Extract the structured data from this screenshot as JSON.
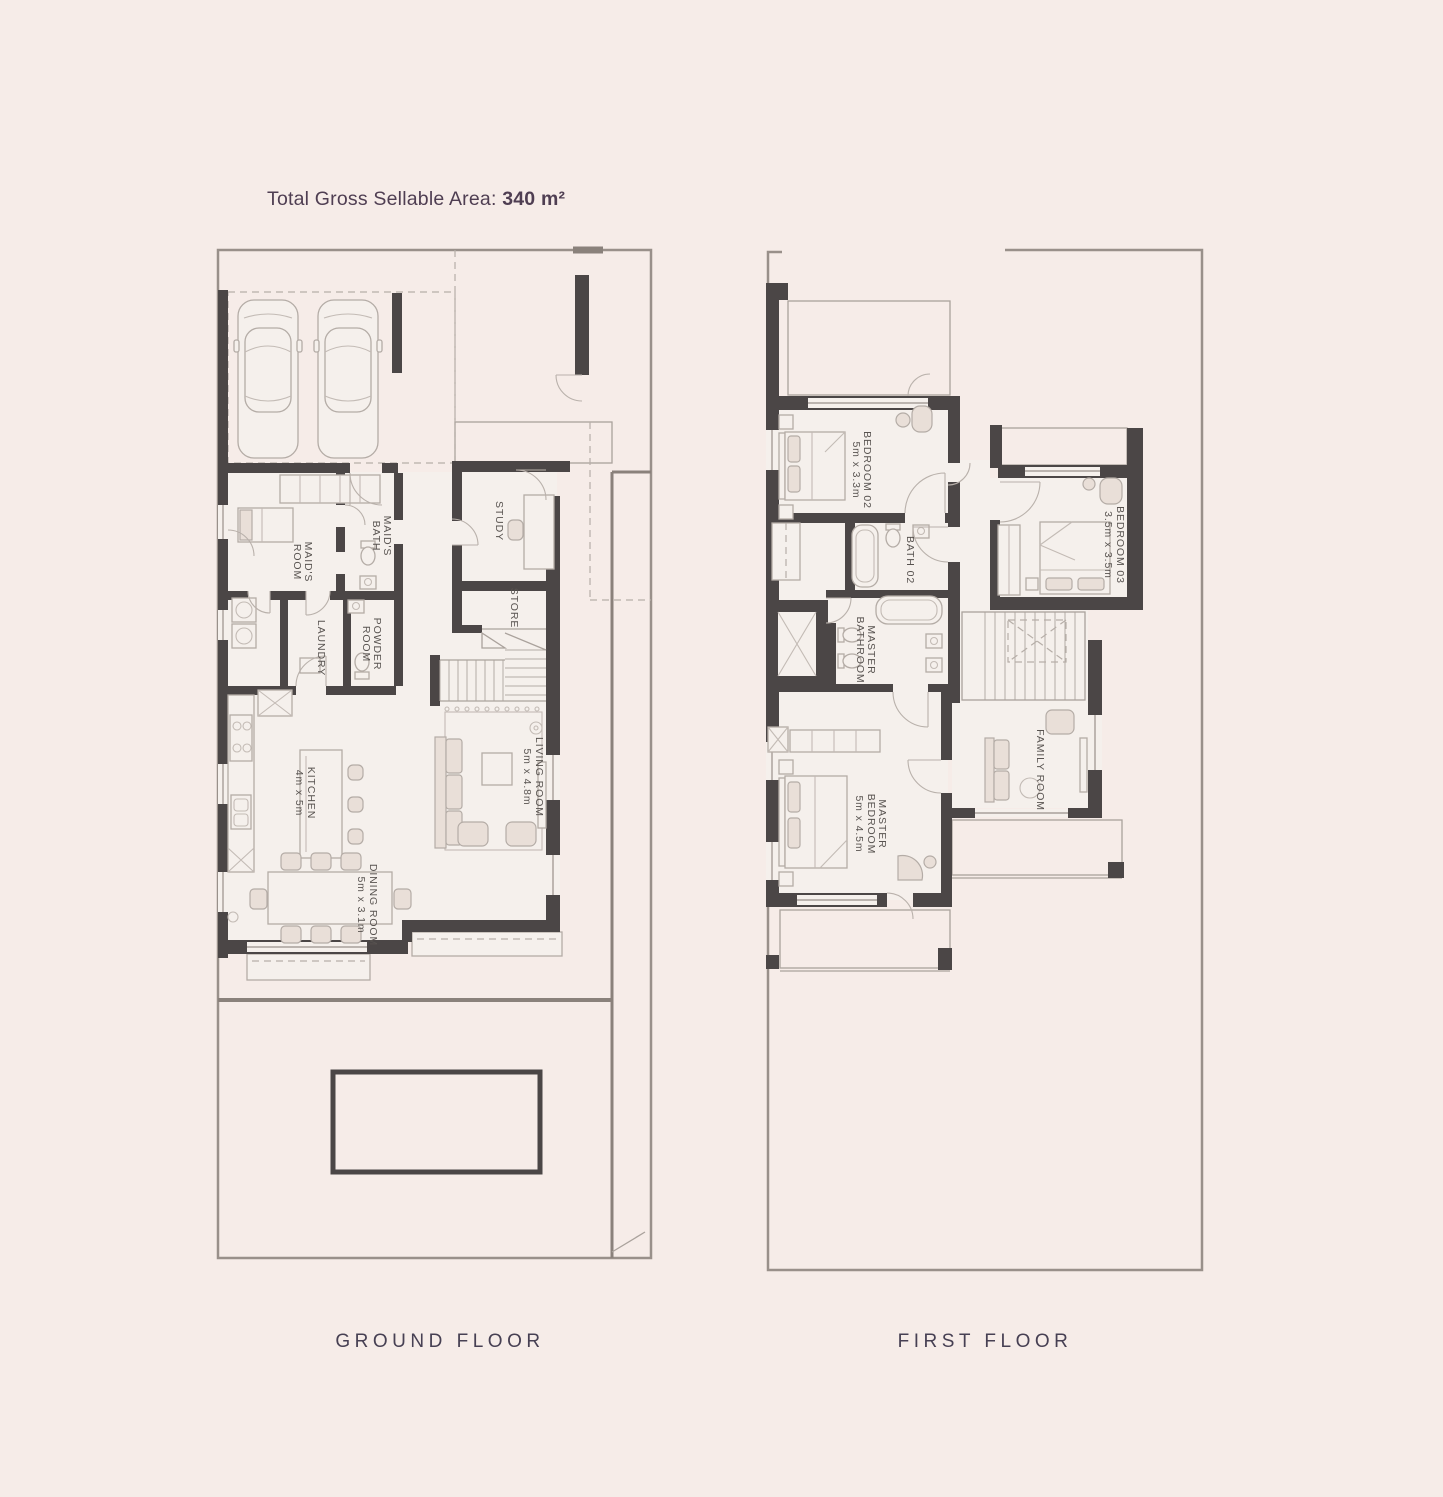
{
  "title": {
    "prefix": "Total Gross Sellable Area: ",
    "value": "340 m²"
  },
  "colors": {
    "background": "#f6ece8",
    "wall": "#4b4646",
    "accent_text": "#4f3e52",
    "plan_text": "#585350"
  },
  "floors": [
    {
      "id": "ground-floor",
      "label": "GROUND FLOOR",
      "rooms": [
        {
          "id": "maids-bath",
          "lines": [
            "MAID'S",
            "BATH"
          ]
        },
        {
          "id": "maids-room",
          "lines": [
            "MAID'S",
            "ROOM"
          ]
        },
        {
          "id": "laundry",
          "lines": [
            "LAUNDRY"
          ]
        },
        {
          "id": "powder-room",
          "lines": [
            "POWDER",
            "ROOM"
          ]
        },
        {
          "id": "study",
          "lines": [
            "STUDY"
          ]
        },
        {
          "id": "store",
          "lines": [
            "STORE"
          ]
        },
        {
          "id": "kitchen",
          "lines": [
            "KITCHEN",
            "4m x 5m"
          ]
        },
        {
          "id": "living-room",
          "lines": [
            "LIVING ROOM",
            "5m x 4.8m"
          ]
        },
        {
          "id": "dining-room",
          "lines": [
            "DINING ROOM",
            "5m x 3.1m"
          ]
        }
      ]
    },
    {
      "id": "first-floor",
      "label": "FIRST FLOOR",
      "rooms": [
        {
          "id": "bedroom-02",
          "lines": [
            "BEDROOM 02",
            "5m x 3.3m"
          ]
        },
        {
          "id": "bedroom-03",
          "lines": [
            "BEDROOM 03",
            "3.5m x 3.5m"
          ]
        },
        {
          "id": "bath-02",
          "lines": [
            "BATH 02"
          ]
        },
        {
          "id": "master-bathroom",
          "lines": [
            "MASTER",
            "BATHROOM"
          ]
        },
        {
          "id": "master-bedroom",
          "lines": [
            "MASTER",
            "BEDROOM",
            "5m x 4.5m"
          ]
        },
        {
          "id": "family-room",
          "lines": [
            "FAMILY ROOM"
          ]
        }
      ]
    }
  ]
}
